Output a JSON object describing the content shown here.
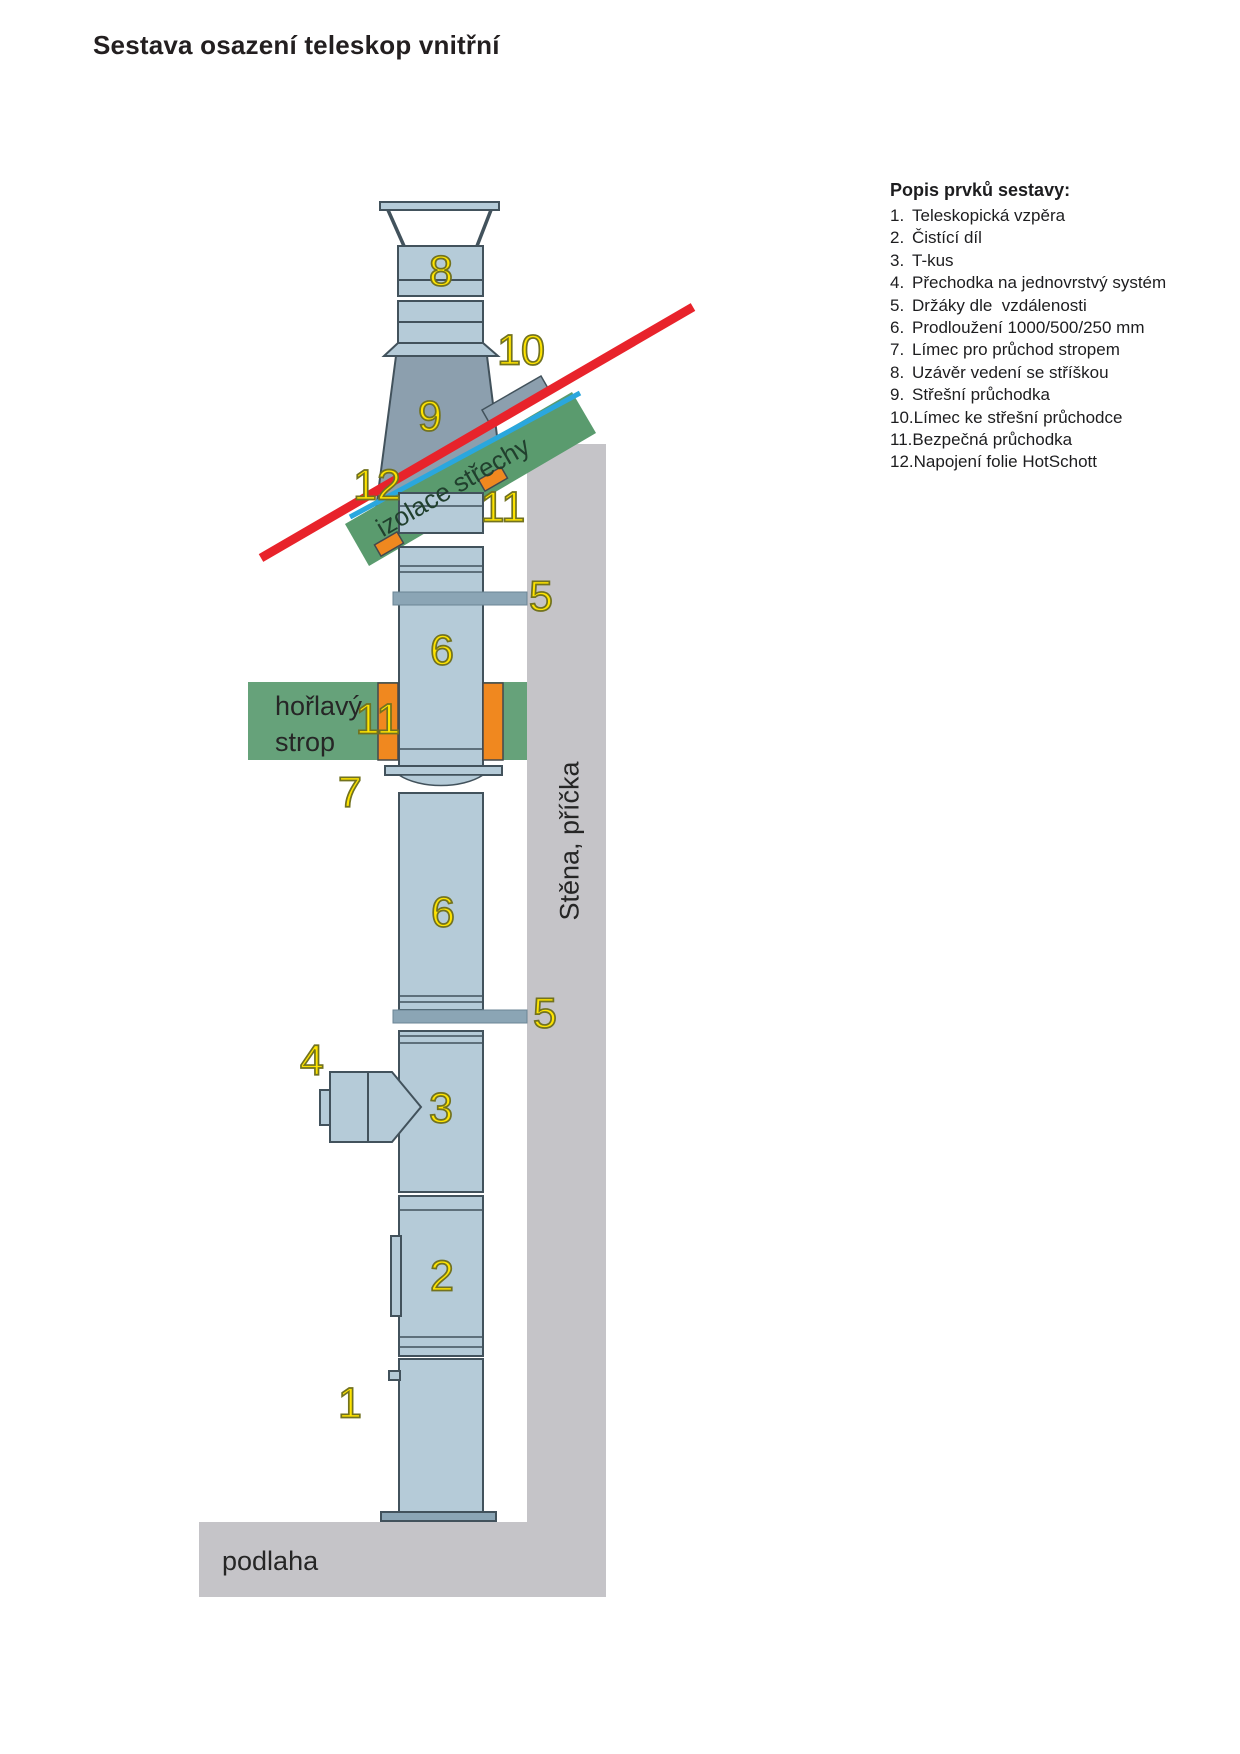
{
  "title": "Sestava osazení teleskop vnitřní",
  "legend": {
    "heading": "Popis prvků sestavy:",
    "items": [
      {
        "num": "1.",
        "label": "Teleskopická vzpěra"
      },
      {
        "num": "2.",
        "label": "Čistící díl"
      },
      {
        "num": "3.",
        "label": "T-kus"
      },
      {
        "num": "4.",
        "label": "Přechodka na jednovrstvý systém"
      },
      {
        "num": "5.",
        "label": "Držáky dle  vzdálenosti"
      },
      {
        "num": "6.",
        "label": "Prodloužení 1000/500/250 mm"
      },
      {
        "num": "7.",
        "label": "Límec pro průchod stropem"
      },
      {
        "num": "8.",
        "label": "Uzávěr vedení se stříškou"
      },
      {
        "num": "9.",
        "label": "Střešní průchodka"
      },
      {
        "num": "10.",
        "label": "Límec ke střešní průchodce"
      },
      {
        "num": "11.",
        "label": "Bezpečná průchodka"
      },
      {
        "num": "12.",
        "label": "Napojení folie HotSchott"
      }
    ]
  },
  "diagram": {
    "area_labels": {
      "roof_insulation": "izolace střechy",
      "ceiling_line1": "hořlavý",
      "ceiling_line2": "strop",
      "wall": "Stěna, příčka",
      "floor": "podlaha"
    },
    "callouts": [
      {
        "n": "8"
      },
      {
        "n": "10"
      },
      {
        "n": "9"
      },
      {
        "n": "12"
      },
      {
        "n": "11"
      },
      {
        "n": "5"
      },
      {
        "n": "6"
      },
      {
        "n": "11"
      },
      {
        "n": "7"
      },
      {
        "n": "6"
      },
      {
        "n": "5"
      },
      {
        "n": "4"
      },
      {
        "n": "3"
      },
      {
        "n": "2"
      },
      {
        "n": "1"
      }
    ],
    "colors": {
      "pipe": "#b5cbd8",
      "pipe_dark": "#8c9fae",
      "outline": "#42525c",
      "wall_gray": "#c5c4c8",
      "roof_insulation_green": "#5a9b6e",
      "ceiling_green": "#66a27a",
      "collar_orange": "#f0881f",
      "roof_line_red": "#e8232b",
      "foil_blue": "#2aa7de",
      "callout_yellow": "#ffe400"
    }
  }
}
